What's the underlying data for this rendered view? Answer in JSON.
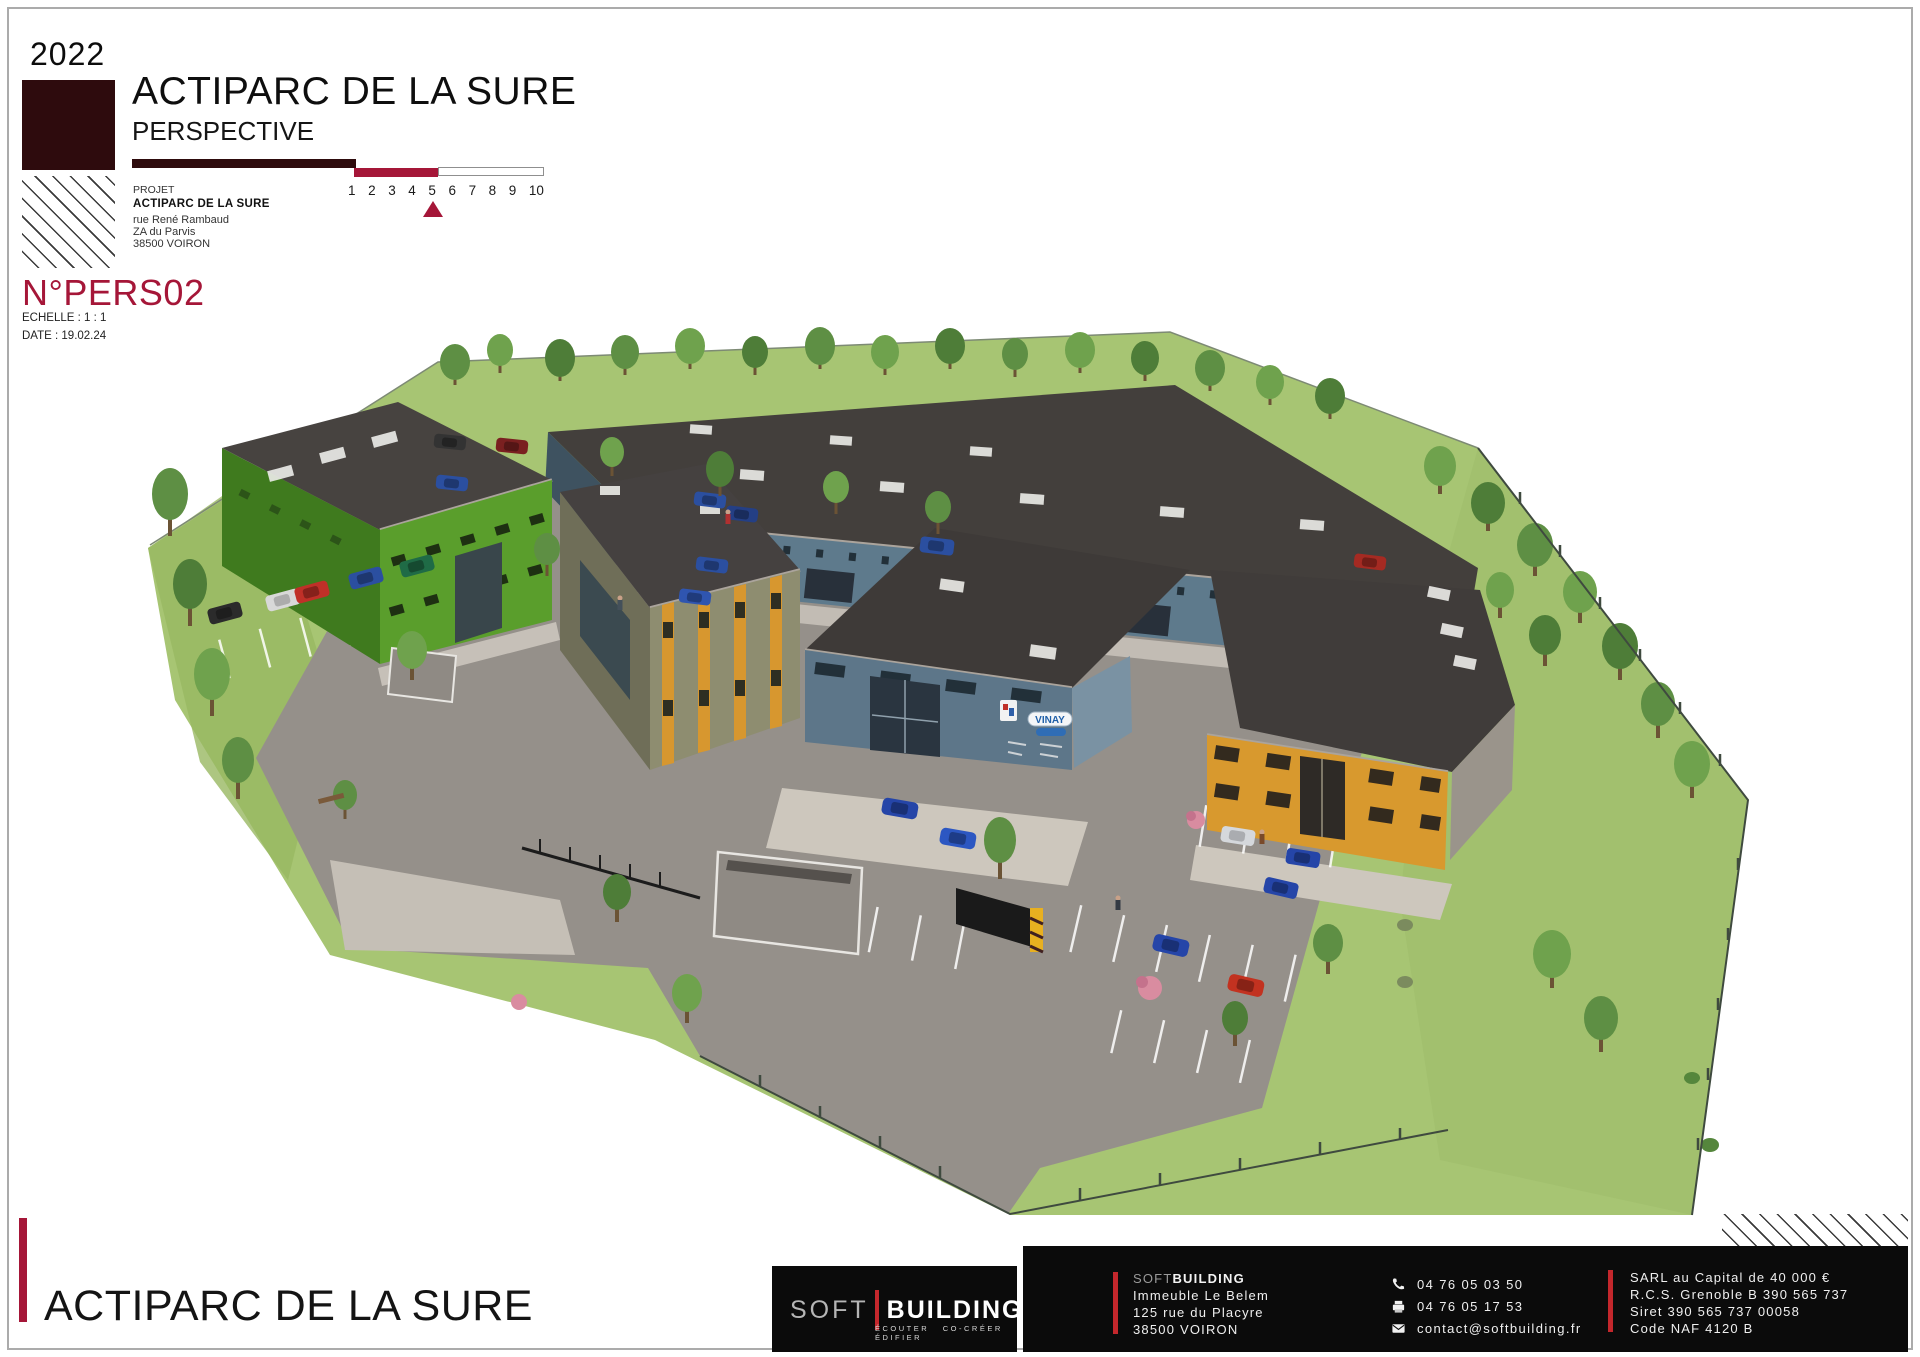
{
  "header": {
    "year": "2022",
    "title": "ACTIPARC DE LA SURE",
    "subtitle": "PERSPECTIVE",
    "projet_label": "PROJET",
    "project_name": "ACTIPARC DE LA SURE",
    "address": {
      "line1": "rue René Rambaud",
      "line2": "ZA du Parvis",
      "line3": "38500 VOIRON"
    },
    "scale_numbers": [
      "1",
      "2",
      "3",
      "4",
      "5",
      "6",
      "7",
      "8",
      "9",
      "10"
    ],
    "drawing_number": "N°PERS02",
    "scale_label": "ECHELLE :  1 : 1",
    "date_label": "DATE : 19.02.24"
  },
  "scene": {
    "description": "3D aerial perspective of the Actiparc de la Sure business park: long blue-grey warehouse at rear, green building at left, olive building with orange window strips, central blue building with VINAY sign, orange building at right, parking lots with cars, lawns, trees and fenced boundary",
    "sign_text": "VINAY"
  },
  "footer": {
    "site_title": "ACTIPARC DE LA SURE",
    "logo": {
      "soft": "SOFT",
      "building": "BUILDING",
      "tagline": "ÉCOUTER CO-CRÉER ÉDIFIER"
    },
    "company": {
      "soft": "SOFT",
      "building": "BUILDING",
      "address1": "Immeuble Le Belem",
      "address2": "125 rue du Placyre",
      "address3": "38500 VOIRON"
    },
    "contact": {
      "phone": "04 76 05 03 50",
      "fax": "04 76 05 17 53",
      "email": "contact@softbuilding.fr"
    },
    "legal": {
      "line1": "SARL au Capital de 40 000 €",
      "line2": "R.C.S. Grenoble B 390 565 737",
      "line3": "Siret 390 565 737 00058",
      "line4": "Code NAF 4120 B"
    }
  },
  "colors": {
    "maroon": "#2E0B0D",
    "crimson": "#A51638",
    "footer_red": "#C4272C",
    "footer_black": "#0B0B0B",
    "grass": "#A7C573",
    "roof": "#413D3A",
    "asphalt": "#95908A"
  }
}
